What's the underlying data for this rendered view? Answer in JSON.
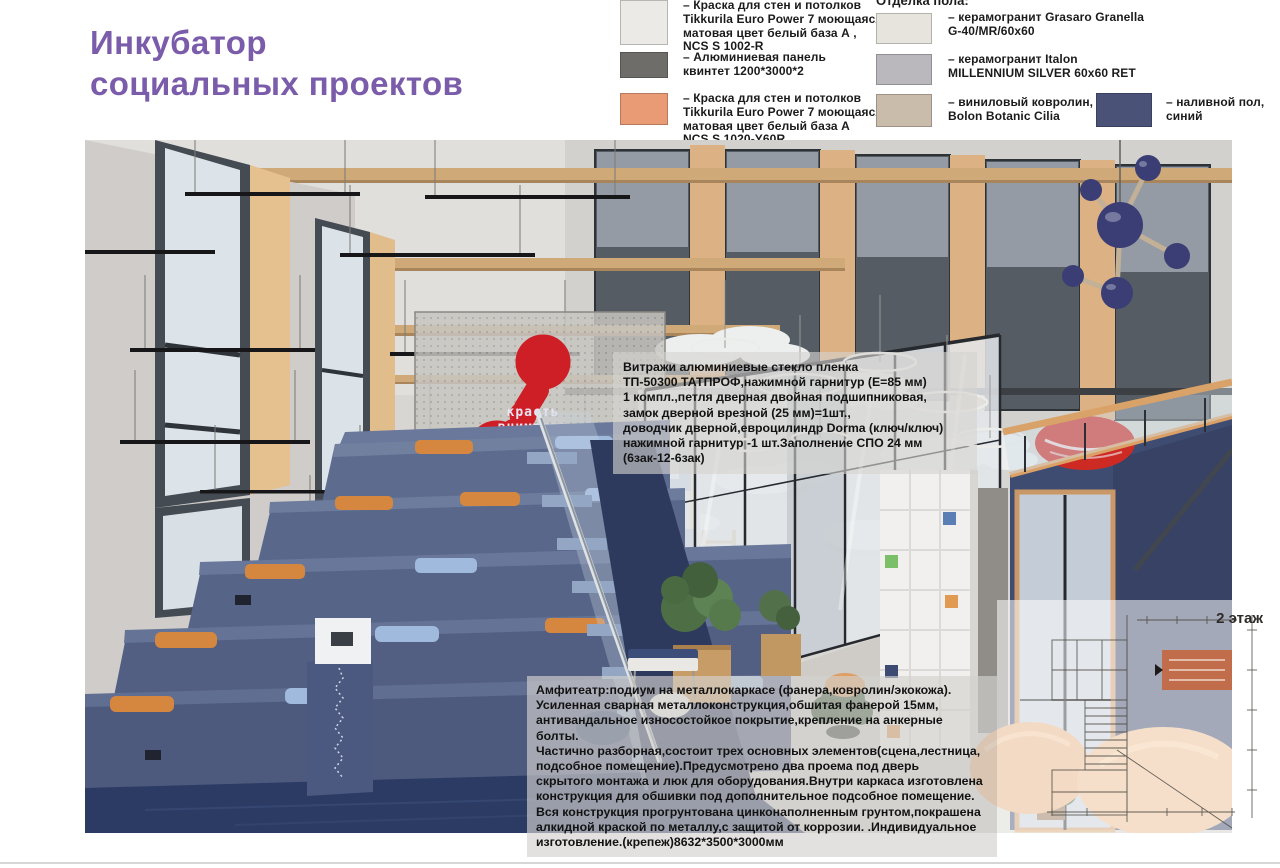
{
  "page": {
    "title": {
      "line1": "Инкубатор",
      "line2": "социальных проектов",
      "color": "#7a5caa"
    }
  },
  "legend": {
    "right_header": "Отделка пола:",
    "left_items": [
      {
        "color": "#eceae6",
        "label": "– Краска для стен и потолков\nTikkurila Euro Power 7 моющаяся\nматовая цвет белый база А ,\nNCS S 1002-R"
      },
      {
        "color": "#6f6d6a",
        "label": "– Алюминиевая панель\nквинтет 1200*3000*2"
      },
      {
        "color": "#e99b76",
        "label": "– Краска для стен и потолков\nTikkurila Euro Power 7 моющаяся\nматовая цвет белый база А\nNCS S 1020-Y60R"
      }
    ],
    "right_items": [
      {
        "color": "#e7e4dd",
        "label": "– керамогранит Grasaro Granella\nG-40/MR/60x60"
      },
      {
        "color": "#bab8bd",
        "label": "– керамогранит Italon\nMILLENNIUM SILVER 60x60 RET"
      },
      {
        "color": "#c9bcab",
        "label": "– виниловый ковролин,\nBolon Botanic Cilia"
      },
      {
        "color": "#4b5278",
        "label": "– наливной пол,\nсиний"
      }
    ]
  },
  "annotations": {
    "vitrage": "Витражи алюминиевые стекло пленка\nТП-50300 ТАТПРОФ,нажимной гарнитур (Е=85 мм)\n1 компл.,петля дверная двойная подшипниковая,\nзамок дверной врезной (25 мм)=1шт.,\nдоводчик дверной,евроцилиндр Dorma (ключ/ключ)\nнажимной гарнитур -1 шт.Заполнение СПО 24 мм\n(6зак-12-6зак)",
    "amphitheater": "Амфитеатр:подиум на металлокаркасе (фанера,ковролин/экокожа).\nУсиленная сварная металлоконструкция,обшитая фанерой 15мм,\nантивандальное износостойкое покрытие,крепление на анкерные болты.\nЧастично разборная,состоит трех основных элементов(сцена,лестница,\nподсобное помещение).Предусмотрено два проема под дверь\nскрытого монтажа и люк для оборудования.Внутри каркаса изготовлена\nконструкция для обшивки под дополнительное подсобное помещение.\nВся конструкция прогрунтована цинконаполненным грунтом,покрашена\nалкидной краской по металлу,с защитой от коррозии. .Индивидуальное\nизготовление.(крепеж)8632*3500*3000мм",
    "floor_plan_label": "2 этаж"
  },
  "render": {
    "logo": {
      "line1": "красть",
      "line2": "внимание",
      "color": "#ce1f26"
    }
  },
  "colors": {
    "title_purple": "#7a5caa",
    "amphitheater_blue": "#56648a",
    "floor_navy": "#2b3b63",
    "pod_blue": "#3f4c72",
    "wood_trim": "#d9a268",
    "cushion_orange": "#d6873f",
    "cushion_blue": "#9fbadd",
    "logo_red": "#ce1f26"
  }
}
